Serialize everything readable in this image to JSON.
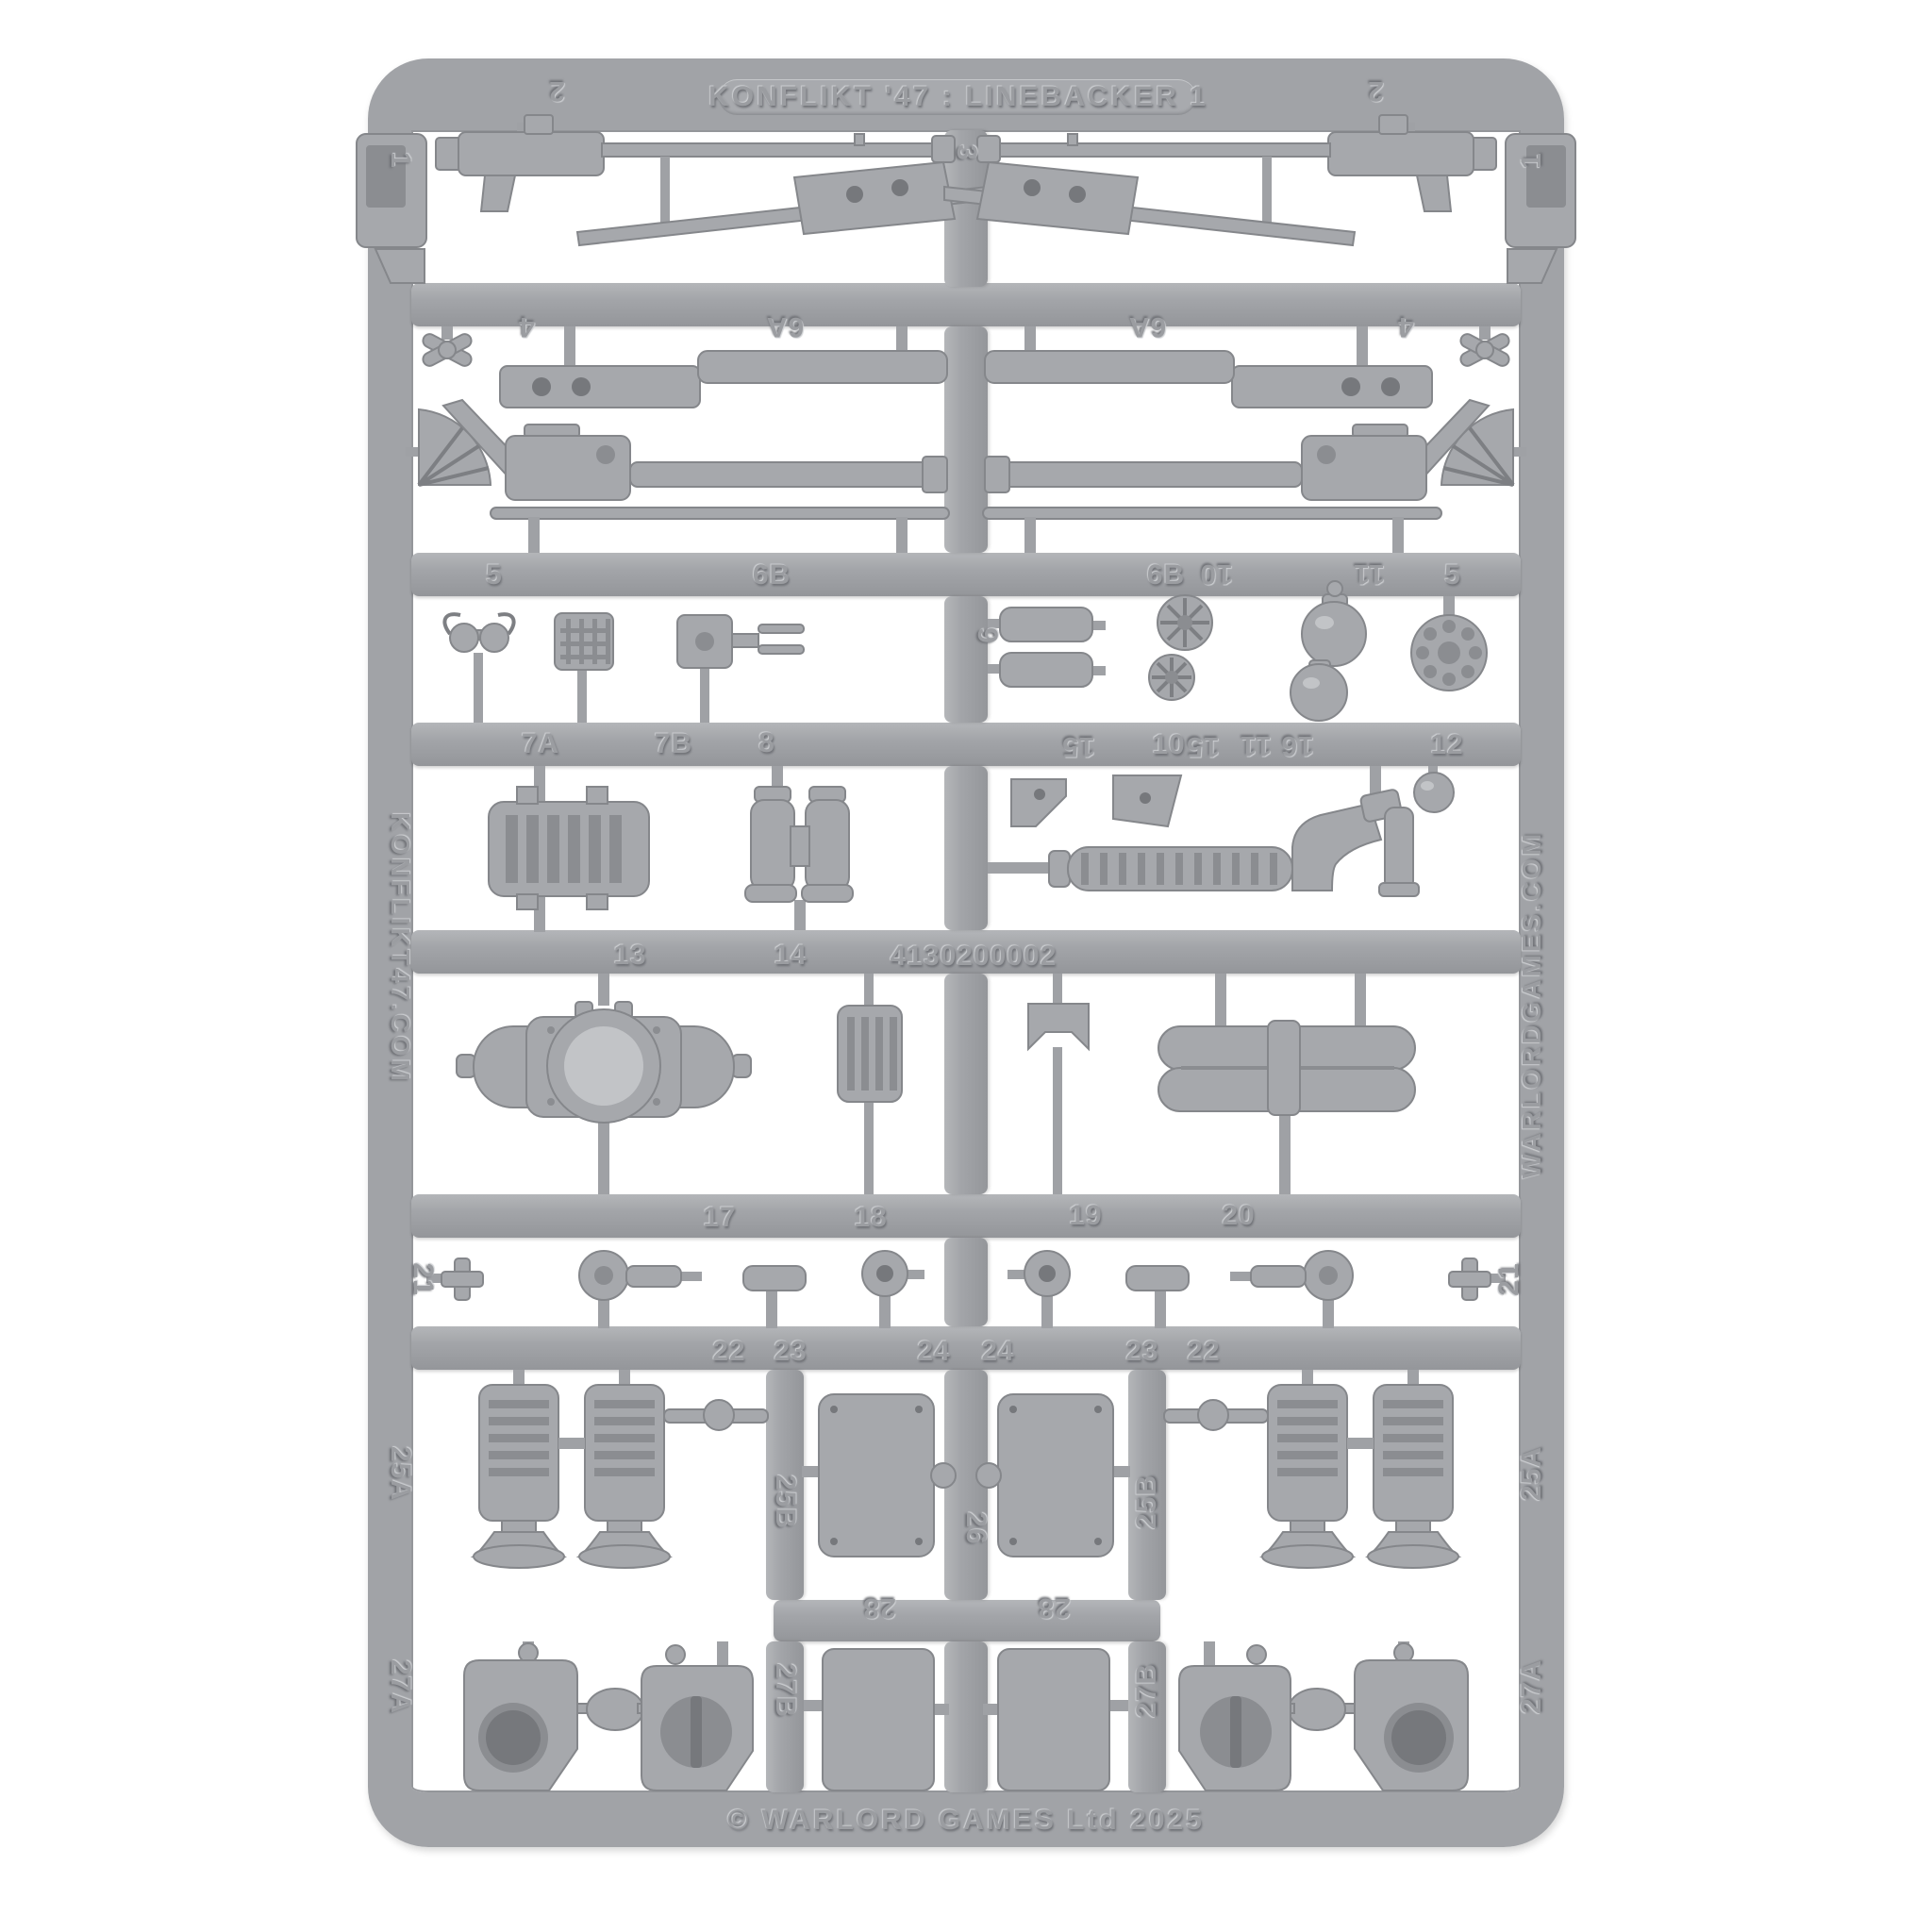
{
  "scene": {
    "description": "Top-down product photograph of a grey injection-moulded plastic model sprue with numbered parts",
    "background_color": "#ffffff",
    "plastic_color": "#a1a3a7"
  },
  "sprue": {
    "title": "KONFLIKT '47 : LINEBACKER 1",
    "product_code": "4130200002",
    "copyright": "© WARLORD GAMES Ltd 2025",
    "left_rail_text": "KONFLIKT47.COM",
    "right_rail_text": "WARLORDGAMES.COM",
    "part_numbers": [
      "1",
      "2",
      "3",
      "4",
      "5",
      "6A",
      "6B",
      "7A",
      "7B",
      "8",
      "9",
      "10",
      "11",
      "12",
      "13",
      "14",
      "15",
      "16",
      "17",
      "18",
      "19",
      "20",
      "21",
      "22",
      "23",
      "24",
      "25A",
      "25B",
      "26",
      "27A",
      "27B",
      "28"
    ]
  },
  "labels": {
    "p1": "1",
    "p2": "2",
    "p3": "3",
    "p4": "4",
    "p5": "5",
    "p6A": "6A",
    "p6B": "6B",
    "p7A": "7A",
    "p7B": "7B",
    "p8": "8",
    "p9": "9",
    "p10": "10",
    "p11": "11",
    "p12": "12",
    "p13": "13",
    "p14": "14",
    "p15": "15",
    "p16": "16",
    "p17": "17",
    "p18": "18",
    "p19": "19",
    "p20": "20",
    "p21": "21",
    "p22": "22",
    "p23": "23",
    "p24": "24",
    "p25A": "25A",
    "p25B": "25B",
    "p26": "26",
    "p27A": "27A",
    "p27B": "27B",
    "p28": "28"
  }
}
